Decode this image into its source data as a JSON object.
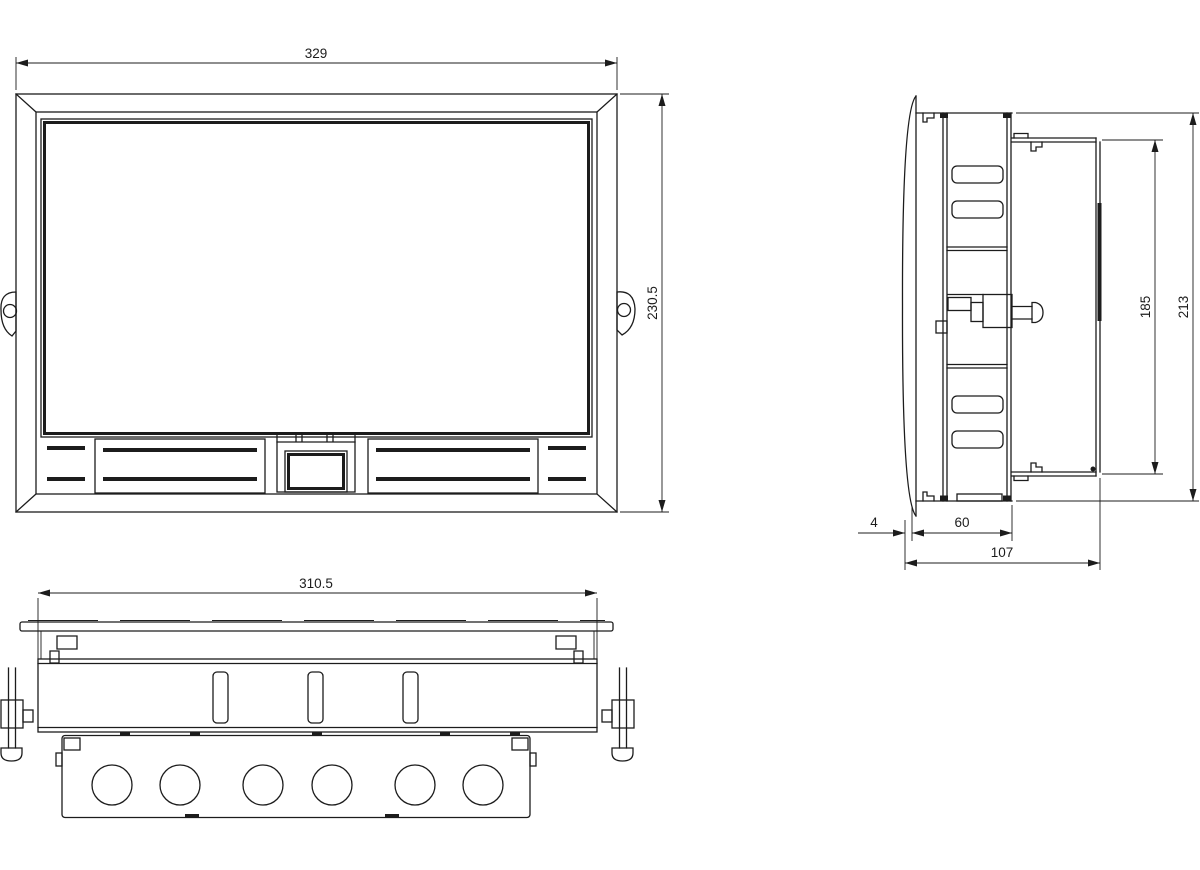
{
  "dimensions": {
    "front_width": "329",
    "front_height": "230.5",
    "cutout_width": "310.5",
    "overall_height": "213",
    "chassis_height": "185",
    "bezel_depth": "4",
    "body_depth": "60",
    "overall_depth": "107"
  },
  "colors": {
    "line": "#1c1c1c",
    "background": "#ffffff"
  }
}
